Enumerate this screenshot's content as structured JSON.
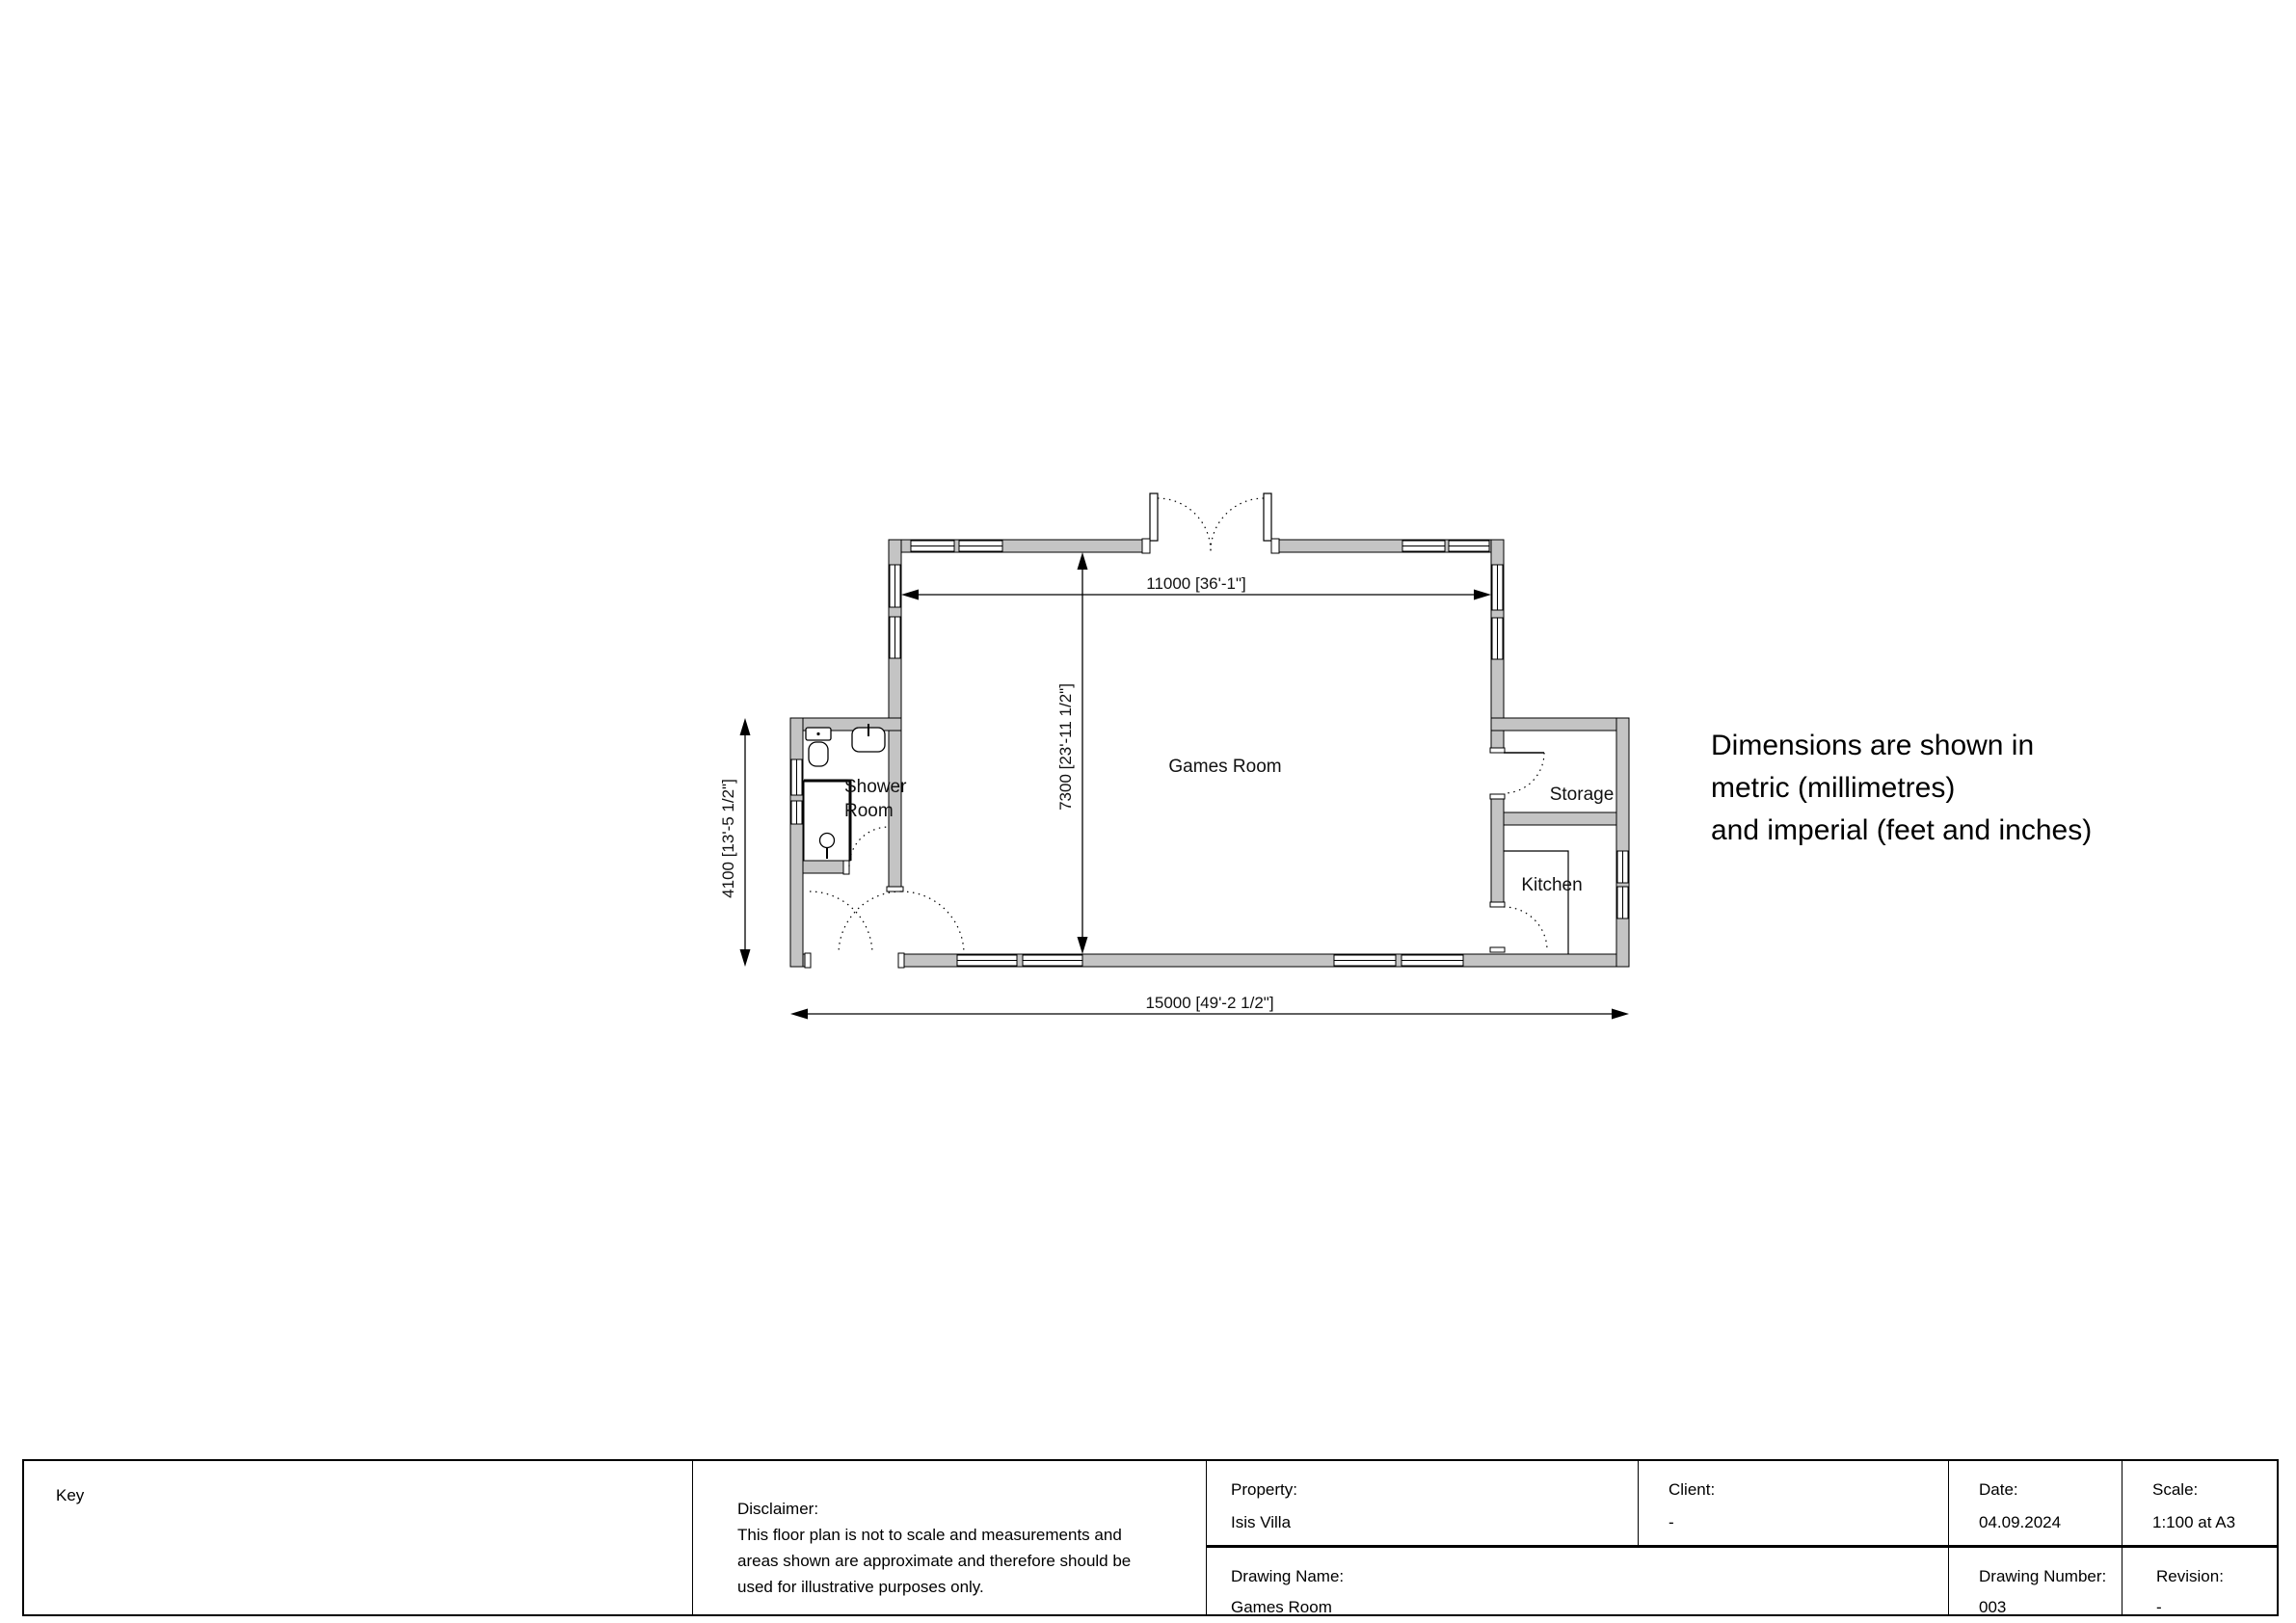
{
  "annotation": {
    "line1": "Dimensions are shown in",
    "line2": "metric (millimetres)",
    "line3": "and imperial (feet and inches)"
  },
  "plan": {
    "rooms": {
      "games_room": "Games Room",
      "shower_room_line1": "Shower",
      "shower_room_line2": "Room",
      "storage": "Storage",
      "kitchen": "Kitchen"
    },
    "dimensions": {
      "interior_width": "11000  [36'-1\"]",
      "interior_depth": "7300  [23'-11 1/2\"]",
      "wing_height": "4100  [13'-5 1/2\"]",
      "overall_width": "15000  [49'-2 1/2\"]"
    }
  },
  "title_block": {
    "key_label": "Key",
    "disclaimer": {
      "heading": "Disclaimer:",
      "line1": "This floor plan is not to scale and measurements and",
      "line2": "areas shown are approximate and therefore should be",
      "line3": "used for illustrative purposes only."
    },
    "property": {
      "label": "Property:",
      "value": "Isis Villa"
    },
    "client": {
      "label": "Client:",
      "value": "-"
    },
    "date": {
      "label": "Date:",
      "value": "04.09.2024"
    },
    "scale": {
      "label": "Scale:",
      "value": "1:100 at A3"
    },
    "drawing_name": {
      "label": "Drawing Name:",
      "value": "Games Room"
    },
    "drawing_number": {
      "label": "Drawing Number:",
      "value": "003"
    },
    "revision": {
      "label": "Revision:",
      "value": "-"
    }
  },
  "colors": {
    "wall_fill": "#c4c4c4",
    "line": "#000000"
  }
}
